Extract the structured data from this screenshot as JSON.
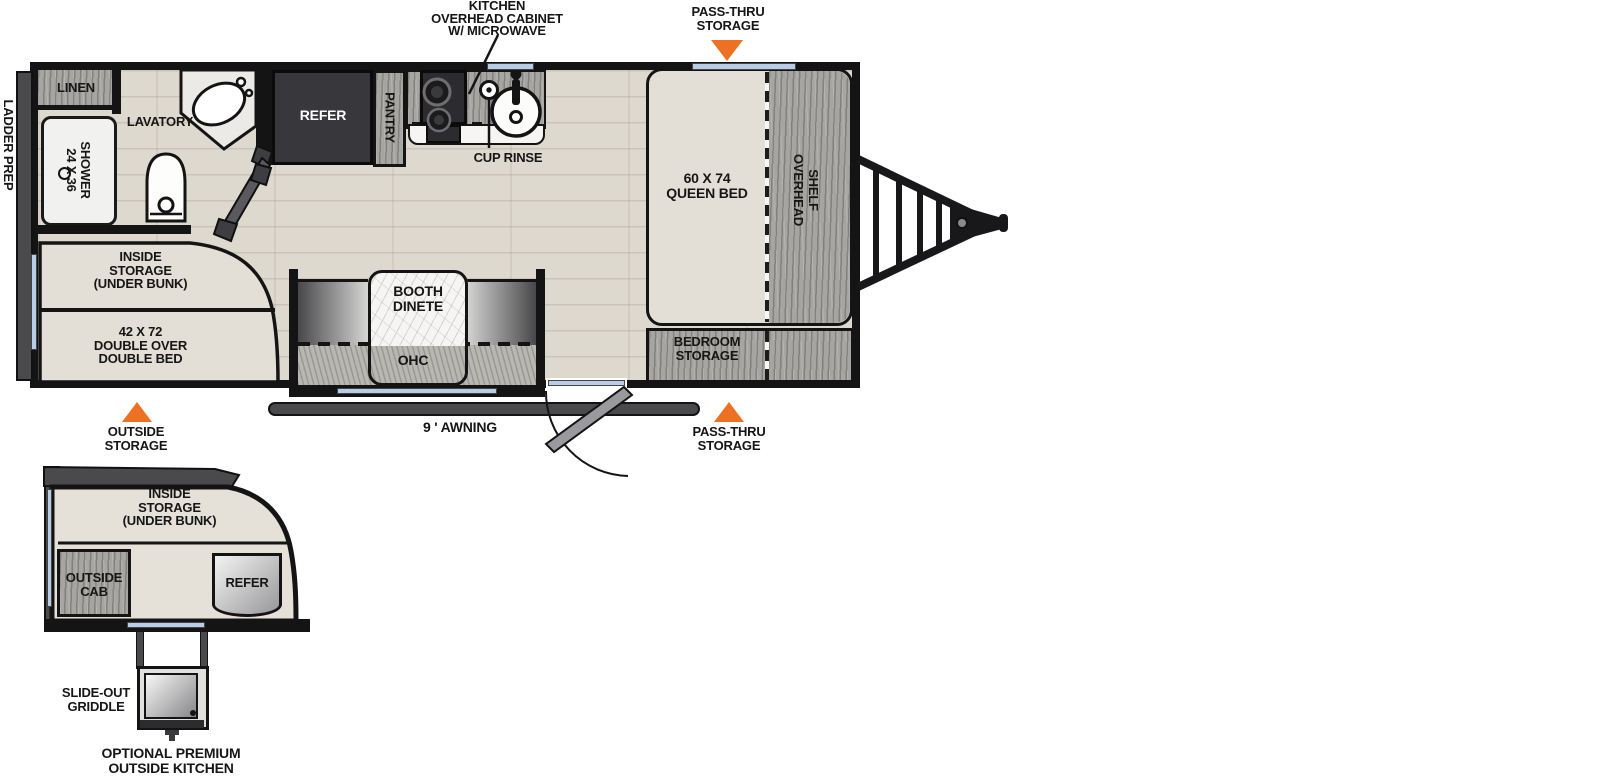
{
  "colors": {
    "accent_orange": "#ed7123",
    "window_blue": "#b9cde6",
    "wall": "#141414"
  },
  "annotations": {
    "kitchen_overhead_cabinet": [
      "KITCHEN",
      "OVERHEAD CABINET",
      "W/ MICROWAVE"
    ],
    "pass_thru_storage_top": [
      "PASS-THRU",
      "STORAGE"
    ],
    "pass_thru_storage_bottom": [
      "PASS-THRU",
      "STORAGE"
    ],
    "outside_storage": [
      "OUTSIDE",
      "STORAGE"
    ],
    "awning": "9 ' AWNING",
    "cup_rinse": "CUP RINSE",
    "ladder_prep": "LADDER PREP"
  },
  "main_plan": {
    "linen": "LINEN",
    "lavatory": "LAVATORY",
    "shower": [
      "24 X 36",
      "SHOWER"
    ],
    "refer": "REFER",
    "pantry": "PANTRY",
    "queen_bed": [
      "60 X 74",
      "QUEEN BED"
    ],
    "overhead_shelf": [
      "OVERHEAD",
      "SHELF"
    ],
    "bedroom_storage": [
      "BEDROOM",
      "STORAGE"
    ],
    "inside_storage": [
      "INSIDE",
      "STORAGE",
      "(UNDER BUNK)"
    ],
    "double_bed": [
      "42 X 72",
      "DOUBLE OVER",
      "DOUBLE BED"
    ],
    "booth_dinette": [
      "BOOTH",
      "DINETE"
    ],
    "ohc": "OHC"
  },
  "optional_plan": {
    "inside_storage": [
      "INSIDE",
      "STORAGE",
      "(UNDER BUNK)"
    ],
    "outside_cab": [
      "OUTSIDE",
      "CAB"
    ],
    "refer": "REFER",
    "slide_out_griddle": [
      "SLIDE-OUT",
      "GRIDDLE"
    ],
    "caption": [
      "OPTIONAL PREMIUM",
      "OUTSIDE KITCHEN"
    ]
  }
}
